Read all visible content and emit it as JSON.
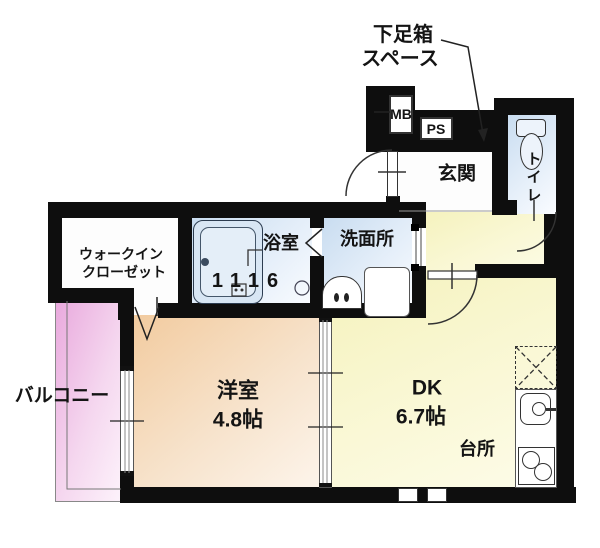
{
  "annotation": {
    "line1": "下足箱",
    "line2": "スペース"
  },
  "utilities": {
    "mb": "MB",
    "ps": "PS"
  },
  "rooms": {
    "entrance": {
      "label": "玄関"
    },
    "toilet": {
      "label": "トイレ"
    },
    "washroom": {
      "label": "洗面所"
    },
    "bathroom": {
      "label": "浴室",
      "size": "1116"
    },
    "walk_in_closet": {
      "label_line1": "ウォークイン",
      "label_line2": "クローゼット"
    },
    "balcony": {
      "label": "バルコニー"
    },
    "western_room": {
      "label": "洋室",
      "size": "4.8帖"
    },
    "dining_kitchen": {
      "label": "DK",
      "size": "6.7帖"
    },
    "kitchen": {
      "label": "台所"
    }
  },
  "colors": {
    "wall": "#0e0e0e",
    "wet_area_floor": "#c8dcf0",
    "dk_floor": "#f7f4c6",
    "western_room_floor": "#f2cb9f",
    "balcony_floor": "#e9a9dd"
  }
}
